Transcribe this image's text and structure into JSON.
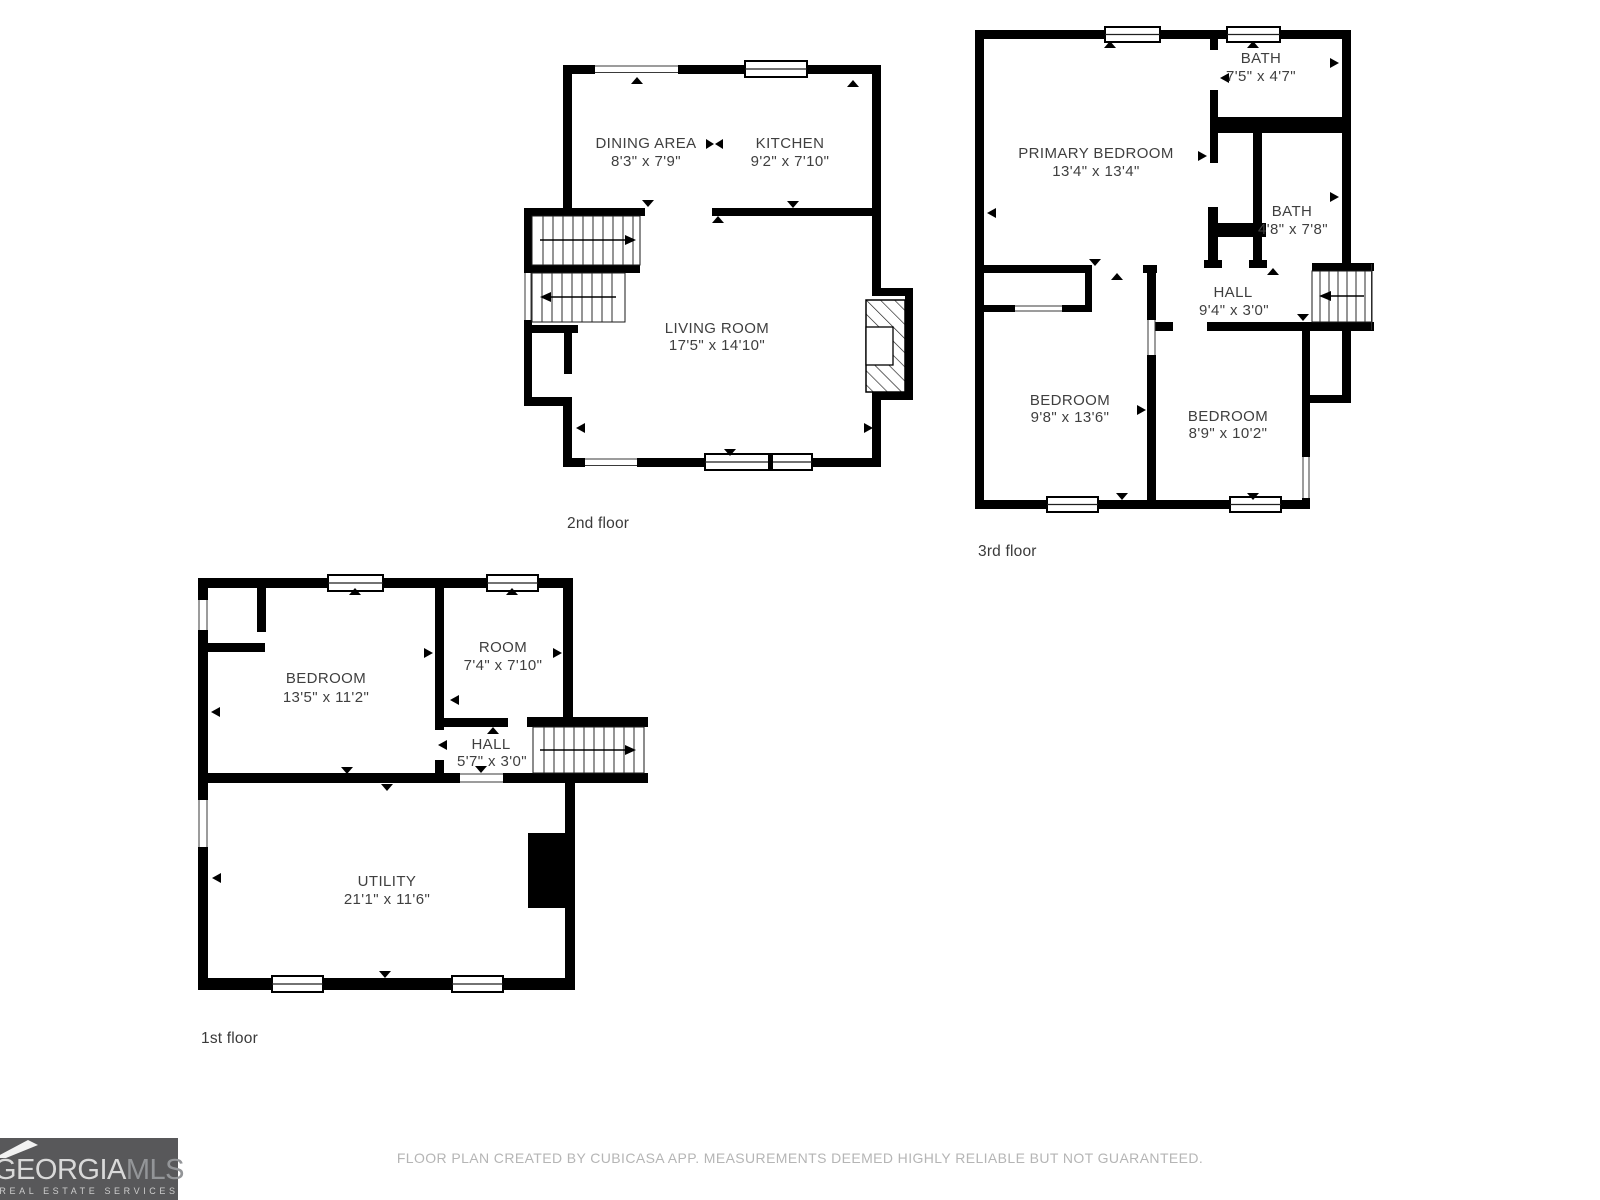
{
  "floors": {
    "second": {
      "label": "2nd floor",
      "rooms": {
        "dining": {
          "name": "DINING AREA",
          "dims": "8'3\" x 7'9\""
        },
        "kitchen": {
          "name": "KITCHEN",
          "dims": "9'2\" x 7'10\""
        },
        "living": {
          "name": "LIVING ROOM",
          "dims": "17'5\" x 14'10\""
        }
      }
    },
    "third": {
      "label": "3rd floor",
      "rooms": {
        "bath1": {
          "name": "BATH",
          "dims": "7'5\" x 4'7\""
        },
        "primary": {
          "name": "PRIMARY BEDROOM",
          "dims": "13'4\" x 13'4\""
        },
        "bath2": {
          "name": "BATH",
          "dims": "4'8\" x 7'8\""
        },
        "hall": {
          "name": "HALL",
          "dims": "9'4\" x 3'0\""
        },
        "bedroom1": {
          "name": "BEDROOM",
          "dims": "9'8\" x 13'6\""
        },
        "bedroom2": {
          "name": "BEDROOM",
          "dims": "8'9\" x 10'2\""
        }
      }
    },
    "first": {
      "label": "1st floor",
      "rooms": {
        "bedroom": {
          "name": "BEDROOM",
          "dims": "13'5\" x 11'2\""
        },
        "room": {
          "name": "ROOM",
          "dims": "7'4\" x 7'10\""
        },
        "hall": {
          "name": "HALL",
          "dims": "5'7\" x 3'0\""
        },
        "utility": {
          "name": "UTILITY",
          "dims": "21'1\" x 11'6\""
        }
      }
    }
  },
  "footer": {
    "disclaimer": "FLOOR PLAN CREATED BY CUBICASA APP. MEASUREMENTS DEEMED HIGHLY RELIABLE BUT NOT GUARANTEED."
  },
  "logo": {
    "brand_primary": "GEORGIA",
    "brand_secondary": "MLS",
    "tagline": "REAL ESTATE SERVICES"
  },
  "colors": {
    "wall": "#000000",
    "room_text": "#3f3f3f",
    "disclaimer_text": "#b5b5b5",
    "logo_background": "#58585a",
    "logo_primary_text": "#d9d9d9",
    "logo_secondary_text": "#939598"
  }
}
